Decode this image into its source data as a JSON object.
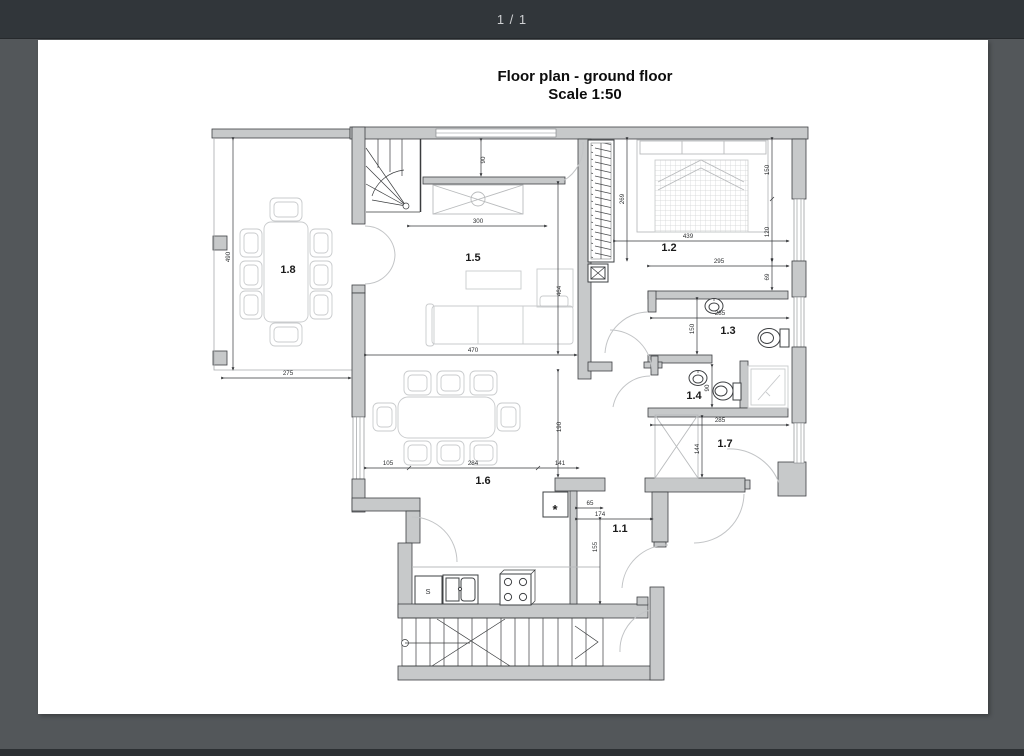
{
  "toolbar": {
    "page_indicator": "1 / 1"
  },
  "document": {
    "title": "Floor plan - ground floor",
    "scale": "Scale 1:50"
  },
  "plan": {
    "room_labels": {
      "r11": "1.1",
      "r12": "1.2",
      "r13": "1.3",
      "r14": "1.4",
      "r15": "1.5",
      "r16": "1.6",
      "r17": "1.7",
      "r18": "1.8"
    },
    "annotations": {
      "sink_unit": "S",
      "asterisk": "*"
    },
    "dimensions": {
      "terrace_height": "490",
      "terrace_width": "275",
      "stair_landing": "90",
      "living_top": "300",
      "living_height": "464",
      "living_width": "470",
      "dining_height": "190",
      "dining_a": "105",
      "dining_b": "284",
      "dining_c": "141",
      "wardrobe_height": "269",
      "bedroom_width": "439",
      "bedroom_side_a": "150",
      "bedroom_side_b": "120",
      "bedroom_lower_width": "295",
      "bedroom_side_c": "69",
      "bath_width": "285",
      "bath_height": "150",
      "wc_height": "90",
      "hall17_width": "285",
      "closet_height": "144",
      "hall_a": "65",
      "hall_b": "174",
      "hall_height": "155"
    },
    "colors": {
      "toolbar_bg": "#31363a",
      "viewer_bg": "#53575a",
      "page_bg": "#ffffff",
      "wall_fill": "#c7c9ca",
      "wall_stroke": "#3e4043",
      "dim_line": "#35373a"
    }
  }
}
